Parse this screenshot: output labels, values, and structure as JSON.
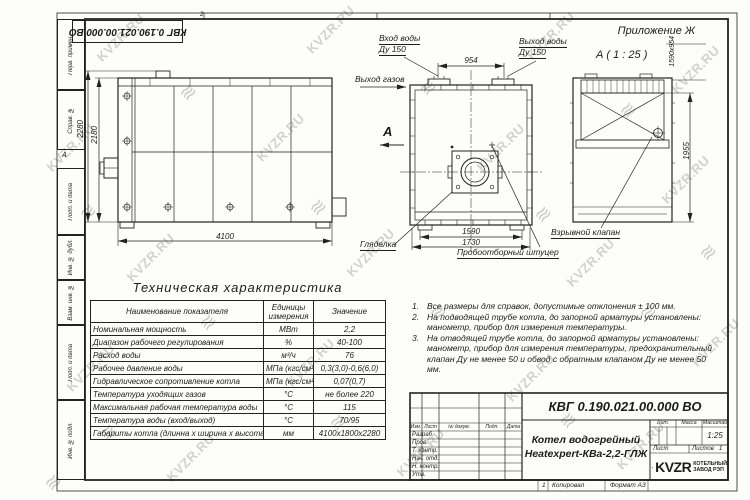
{
  "watermark": {
    "text": "KVZR.RU",
    "logo_glyph": "≋"
  },
  "page": {
    "appendix": "Приложение Ж"
  },
  "frame": {
    "zone_top": "2",
    "zone_left": "А",
    "rotated_doc_number": "КВГ 0.190.021.00.000 ВО",
    "left_column_labels": [
      "Перв. примен.",
      "Справ. №",
      "Подп. и дата",
      "Инв. № дубл.",
      "Взам. инв. №",
      "Подп. и дата",
      "Инв. № подл."
    ]
  },
  "views": {
    "side_view": {
      "dim_height_total": "2280",
      "dim_height_body": "2180",
      "dim_length": "4100"
    },
    "front_view": {
      "view_arrow": "А",
      "label_water_in_line1": "Вход воды",
      "label_water_in_line2": "Ду 150",
      "label_water_out_line1": "Выход воды",
      "label_water_out_line2": "Ду 150",
      "label_gas_out": "Выход газов",
      "dim_nozzles": "954",
      "dim_width_inner": "1590",
      "dim_width_outer": "1730",
      "label_sight_glass": "Гляделка",
      "label_sampling_fitting": "Пробоотборный штуцер"
    },
    "top_view": {
      "title": "А ( 1 : 25 )",
      "dim_hatch": "1590х954",
      "dim_depth": "1955",
      "label_explosion_valve": "Взрывной клапан"
    }
  },
  "table": {
    "title": "Техническая характеристика",
    "headers": [
      "Наименование показателя",
      "Единицы измерения",
      "Значение"
    ],
    "rows": [
      [
        "Номинальная мощность",
        "МВт",
        "2,2"
      ],
      [
        "Диапазон рабочего регулирования",
        "%",
        "40-100"
      ],
      [
        "Расход воды",
        "м³/ч",
        "76"
      ],
      [
        "Рабочее давление воды",
        "МПа (кгс/см²)",
        "0,3(3,0)-0,6(6,0)"
      ],
      [
        "Гидравлическое сопротивление котла",
        "МПа (кгс/см²)",
        "0,07(0,7)"
      ],
      [
        "Температура уходящих газов",
        "°С",
        "не более 220"
      ],
      [
        "Максимальная рабочая температура воды",
        "°С",
        "115"
      ],
      [
        "Температура воды (вход/выход)",
        "°С",
        "70/95"
      ],
      [
        "Габариты котла (длинна х ширина х высота)",
        "мм",
        "4100х1800х2280"
      ]
    ]
  },
  "notes": [
    {
      "n": "1.",
      "t": "Все размеры для справок, допустимые отклонения ± 100 мм."
    },
    {
      "n": "2.",
      "t": "На подводящей трубе котла, до запорной арматуры установлены: манометр, прибор для измерения температуры."
    },
    {
      "n": "3.",
      "t": "На отводящей трубе котла, до запорной арматуры установлены: манометр, прибор для измерения температуры, предохранительный клапан Ду не менее 50 и обвод с обратным клапаном Ду не менее 50 мм."
    }
  ],
  "titleblock": {
    "doc_number": "КВГ 0.190.021.00.000 ВО",
    "product_line1": "Котел водогрейный",
    "product_line2": "Heatexpert-КВа-2,2-ГЛЖ",
    "col_izm": "Изм.",
    "col_list": "Лист",
    "col_doc": "№ докум.",
    "col_podp": "Подп.",
    "col_data": "Дата",
    "rows": [
      "Разраб.",
      "Пров.",
      "Т. контр.",
      "Нач. отд.",
      "Н. контр.",
      "Утв."
    ],
    "lit": "Лит.",
    "mass": "Масса",
    "scale": "Масштаб",
    "scale_value": "1:25",
    "sheet": "Лист",
    "sheets": "Листов",
    "sheets_value": "1",
    "logo": "KVZR",
    "logo_line1": "КОТЕЛЬНЫЙ",
    "logo_line2": "ЗАВОД РЭП",
    "footer_num": "1",
    "footer_copy": "Копировал",
    "footer_format": "Формат А3"
  }
}
